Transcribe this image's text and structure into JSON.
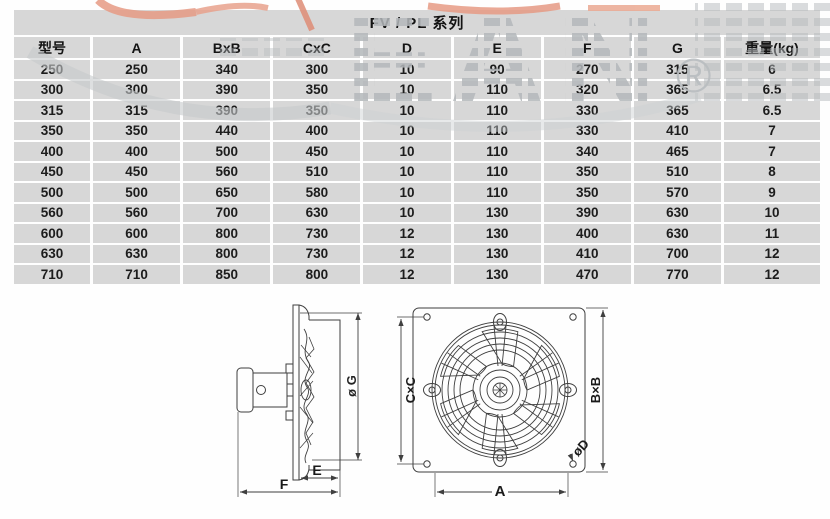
{
  "title": "FV / PL 系列",
  "table": {
    "headers": [
      "型号",
      "A",
      "BxB",
      "CxC",
      "D",
      "E",
      "F",
      "G",
      "重量(kg)"
    ],
    "rows": [
      [
        "250",
        "250",
        "340",
        "300",
        "10",
        "90",
        "270",
        "315",
        "6"
      ],
      [
        "300",
        "300",
        "390",
        "350",
        "10",
        "110",
        "320",
        "365",
        "6.5"
      ],
      [
        "315",
        "315",
        "390",
        "350",
        "10",
        "110",
        "330",
        "365",
        "6.5"
      ],
      [
        "350",
        "350",
        "440",
        "400",
        "10",
        "110",
        "330",
        "410",
        "7"
      ],
      [
        "400",
        "400",
        "500",
        "450",
        "10",
        "110",
        "340",
        "465",
        "7"
      ],
      [
        "450",
        "450",
        "560",
        "510",
        "10",
        "110",
        "350",
        "510",
        "8"
      ],
      [
        "500",
        "500",
        "650",
        "580",
        "10",
        "110",
        "350",
        "570",
        "9"
      ],
      [
        "560",
        "560",
        "700",
        "630",
        "10",
        "130",
        "390",
        "630",
        "10"
      ],
      [
        "600",
        "600",
        "800",
        "730",
        "12",
        "130",
        "400",
        "630",
        "11"
      ],
      [
        "630",
        "630",
        "800",
        "730",
        "12",
        "130",
        "410",
        "700",
        "12"
      ],
      [
        "710",
        "710",
        "850",
        "800",
        "12",
        "130",
        "470",
        "770",
        "12"
      ]
    ]
  },
  "diagram": {
    "side_view": {
      "label_g": "ø G",
      "label_e": "E",
      "label_f": "F"
    },
    "front_view": {
      "label_cxc": "C×C",
      "label_bxb": "B×B",
      "label_a": "A",
      "label_d": "øD"
    }
  },
  "watermark": {
    "registered_symbol": "®"
  },
  "colors": {
    "cell_bg": "#d7d7d7",
    "text": "#1c1c1c",
    "line": "#3f3f3f",
    "watermark_gray": "#b4b8bb",
    "watermark_accent": "#e69a84"
  }
}
